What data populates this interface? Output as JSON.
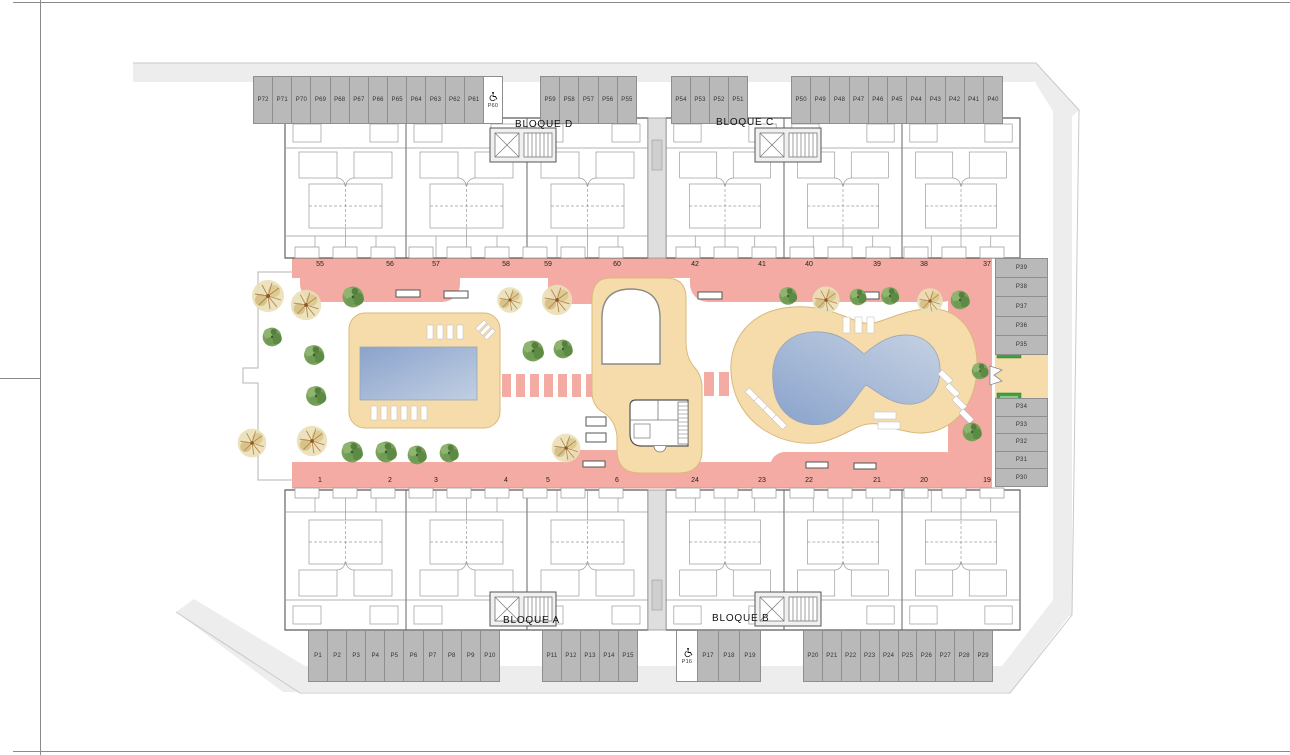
{
  "plan": {
    "type": "residential site plan, ground floor",
    "blocks": {
      "d": "BLOQUE D",
      "c": "BLOQUE C",
      "a": "BLOQUE A",
      "b": "BLOQUE B"
    },
    "parking": {
      "top_left": [
        "P72",
        "P71",
        "P70",
        "P69",
        "P68",
        "P67",
        "P66",
        "P65",
        "P64",
        "P63",
        "P62",
        "P61"
      ],
      "top_left_accessible": "P60",
      "top_mid": [
        "P59",
        "P58",
        "P57",
        "P56",
        "P55"
      ],
      "top_right_a": [
        "P54",
        "P53",
        "P52",
        "P51"
      ],
      "top_right_b": [
        "P50",
        "P49",
        "P48",
        "P47",
        "P46",
        "P45",
        "P44",
        "P43",
        "P42",
        "P41",
        "P40"
      ],
      "right_upper": [
        "P39",
        "P38",
        "P37",
        "P36",
        "P35"
      ],
      "right_lower": [
        "P34",
        "P33",
        "P32",
        "P31",
        "P30"
      ],
      "bottom_left": [
        "P1",
        "P2",
        "P3",
        "P4",
        "P5",
        "P6",
        "P7",
        "P8",
        "P9",
        "P10"
      ],
      "bottom_mid": [
        "P11",
        "P12",
        "P13",
        "P14",
        "P15"
      ],
      "bottom_accessible": "P16",
      "bottom_mid2": [
        "P17",
        "P18",
        "P19"
      ],
      "bottom_right": [
        "P20",
        "P21",
        "P22",
        "P23",
        "P24",
        "P25",
        "P26",
        "P27",
        "P28",
        "P29"
      ]
    },
    "terraces": {
      "top": [
        "55",
        "56",
        "57",
        "58",
        "59",
        "60",
        "42",
        "41",
        "40",
        "39",
        "38",
        "37"
      ],
      "bottom": [
        "1",
        "2",
        "3",
        "4",
        "5",
        "6",
        "24",
        "23",
        "22",
        "21",
        "20",
        "19"
      ]
    },
    "colors": {
      "walkway_pink": "#f4aba3",
      "deck_beige": "#f7dcab",
      "pool_blue_dark": "#8aa3cc",
      "pool_blue_light": "#c2cfe2",
      "parking_gray": "#b9b9b9",
      "site_band_gray": "#ededed",
      "access_badge_green": "#3da33d"
    }
  }
}
